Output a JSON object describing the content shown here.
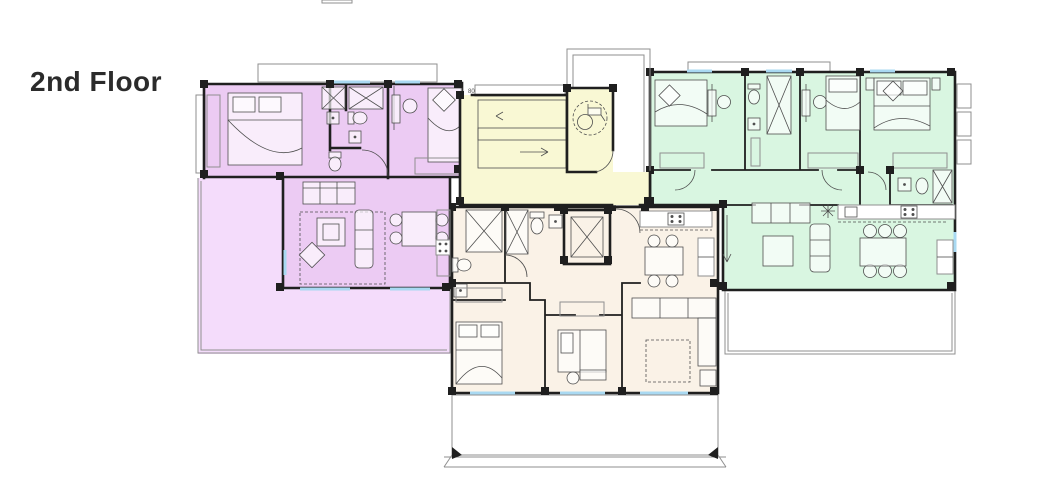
{
  "header": {
    "title": "2nd Floor"
  },
  "core": {
    "dimension_label": "80"
  },
  "colors": {
    "bg": "#ffffff",
    "title": "#2b2b2b",
    "wall": "#1f1f1f",
    "line": "#4f4f4f",
    "muted": "#8f8f8f",
    "window": "#a9d9f2",
    "purpleRoom": "#eccbf3",
    "purpleTerrace": "#f4dcfb",
    "greenRoom": "#d9f6e1",
    "greenTerrace": "#e2fbe9",
    "core": "#f9f8d4",
    "cream": "#faf2e7"
  },
  "icons": {
    "stairs": "stairs-icon",
    "elevator": "elevator-icon",
    "wheelchair": "accessible-wc-icon"
  }
}
